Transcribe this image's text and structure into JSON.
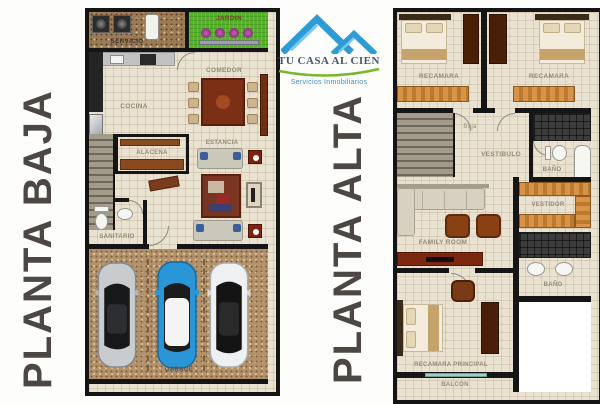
{
  "logo": {
    "title": "TU CASA AL CIEN",
    "subtitle": "Servicios Inmobiliarios"
  },
  "planta_baja": {
    "title": "PLANTA BAJA",
    "rooms": {
      "servicio": "SERVICIO",
      "jardin": "JARDIN",
      "cocina": "COCINA",
      "comedor": "COMEDOR",
      "alacena": "ALACENA",
      "estancia": "ESTANCIA",
      "sanitario": "SANITARIO",
      "garage": "GARAGE"
    }
  },
  "planta_alta": {
    "title": "PLANTA ALTA",
    "rooms": {
      "recamara_1": "RECAMARA",
      "recamara_2": "RECAMARA",
      "baja": "Baja",
      "vestibulo": "VESTIBULO",
      "bano_1": "BAÑO",
      "vestidor": "VESTIDOR",
      "family_room": "FAMILY ROOM",
      "bano_2": "BAÑO",
      "recamara_principal": "RECAMARA PRINCIPAL",
      "balcon": "BALCON"
    }
  },
  "colors": {
    "wall": "#151515",
    "floor": "#eae2d1",
    "wood": "#c9873d",
    "grass_green": "#58b02a",
    "garage_floor": "#b3926b",
    "logo_blue": "#2e9bd6",
    "logo_green": "#76b82a",
    "title_gray": "#4c4742",
    "car_blue": "#2a96d8"
  }
}
